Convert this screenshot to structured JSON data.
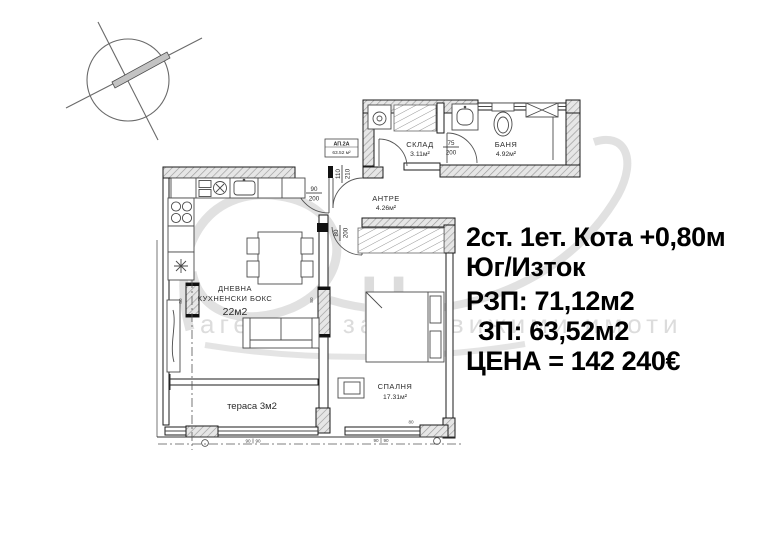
{
  "info_panel": {
    "line1": "2ст. 1ет. Кота +0,80м",
    "line2": "Юг/Изток",
    "line3": "РЗП: 71,12м2",
    "line4": "ЗП: 63,52м2",
    "line5": "ЦЕНА = 142 240€"
  },
  "apartment_tag": {
    "id": "АП.2А",
    "area": "63.52 м²"
  },
  "rooms": {
    "storage": {
      "name": "СКЛАД",
      "area": "3.11м²"
    },
    "bathroom": {
      "name": "БАНЯ",
      "area": "4.92м²"
    },
    "hallway": {
      "name": "АНТРЕ",
      "area": "4.26м²"
    },
    "living": {
      "line1": "ДНЕВНА",
      "line2": "КУХНЕНСКИ  БОКС",
      "area": "22м2"
    },
    "bedroom": {
      "name": "СПАЛНЯ",
      "area": "17.31м²"
    },
    "terrace": {
      "label": "тераса 3м2"
    }
  },
  "door_dims": {
    "bath": {
      "w": "75",
      "h": "200"
    },
    "living": {
      "w": "90",
      "h": "200"
    },
    "bedroom": {
      "w": "80",
      "h": "200"
    },
    "entry": {
      "w": "110",
      "h": "210"
    }
  },
  "small_dims": {
    "column": "80",
    "window": "90"
  },
  "watermark": {
    "monogram": "Н",
    "caption": "агенция за недвижими имоти"
  },
  "colors": {
    "ink": "#000000",
    "watermark": "#d7d7d7",
    "hatch_bg": "#e6e6e6"
  }
}
